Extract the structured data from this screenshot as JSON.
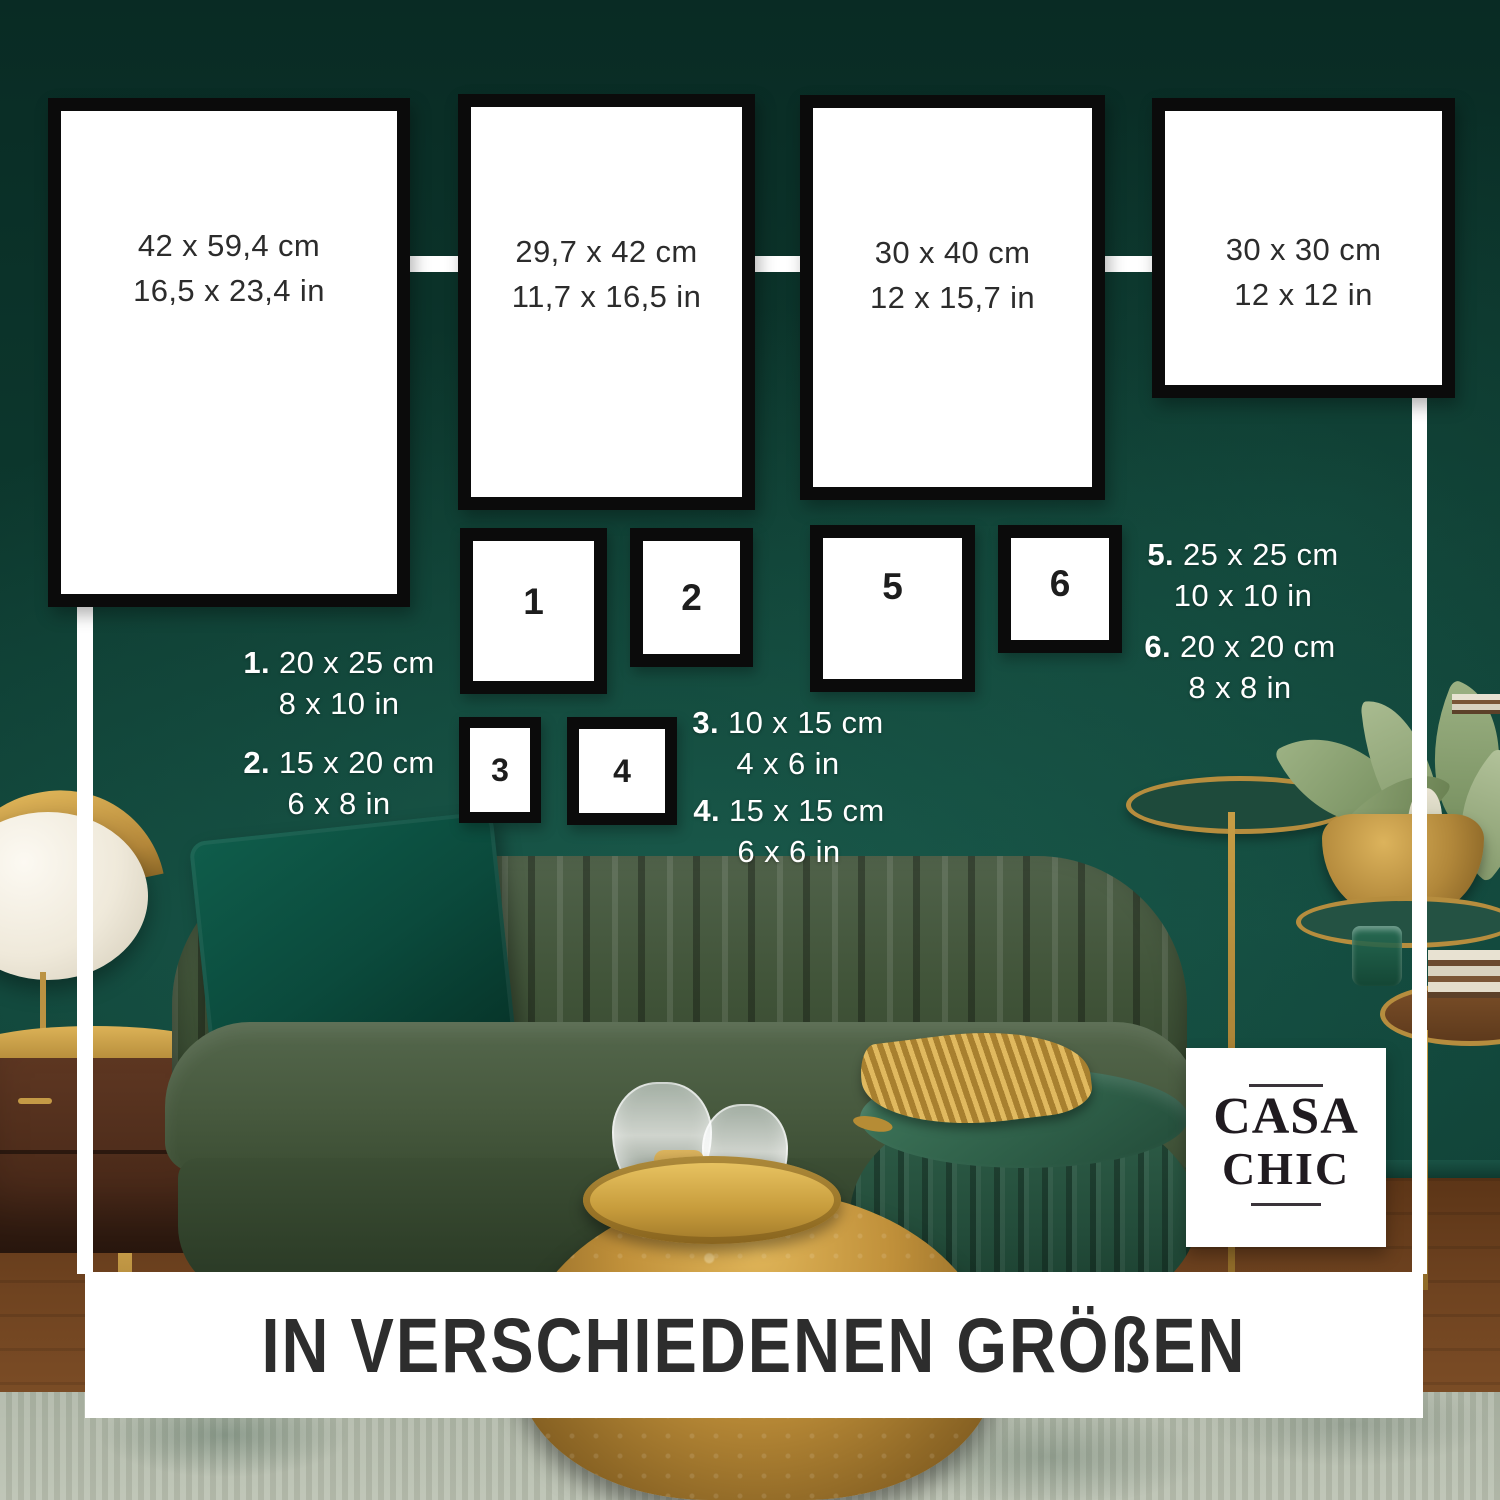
{
  "brand": {
    "name_line1": "CASA",
    "name_line2": "CHIC"
  },
  "banner": {
    "title": "IN VERSCHIEDENEN GRÖßEN"
  },
  "large_frames": [
    {
      "label_cm": "42 x 59,4 cm",
      "label_in": "16,5 x 23,4 in"
    },
    {
      "label_cm": "29,7 x 42 cm",
      "label_in": "11,7 x 16,5 in"
    },
    {
      "label_cm": "30 x 40 cm",
      "label_in": "12 x 15,7 in"
    },
    {
      "label_cm": "30 x 30 cm",
      "label_in": "12 x 12 in"
    }
  ],
  "numbered_frames": [
    {
      "number": "1"
    },
    {
      "number": "2"
    },
    {
      "number": "3"
    },
    {
      "number": "4"
    },
    {
      "number": "5"
    },
    {
      "number": "6"
    }
  ],
  "legend": [
    {
      "num": "1.",
      "cm": "20 x 25 cm",
      "in": "8 x 10 in"
    },
    {
      "num": "2.",
      "cm": "15 x 20 cm",
      "in": "6 x 8 in"
    },
    {
      "num": "3.",
      "cm": "10 x 15 cm",
      "in": "4 x 6 in"
    },
    {
      "num": "4.",
      "cm": "15 x 15 cm",
      "in": "6 x 6 in"
    },
    {
      "num": "5.",
      "cm": "25 x 25 cm",
      "in": "10 x 10 in"
    },
    {
      "num": "6.",
      "cm": "20 x 20 cm",
      "in": "8 x 8 in"
    }
  ],
  "colors": {
    "wall_green": "#0f3d32",
    "frame_border": "#0b0b0b",
    "frame_fill": "#ffffff",
    "dimension_text": "#2c2c2c",
    "legend_text": "#ffffff",
    "banner_bg": "#ffffff",
    "banner_text": "#2d2d2d",
    "accent_gold": "#c49a46"
  }
}
